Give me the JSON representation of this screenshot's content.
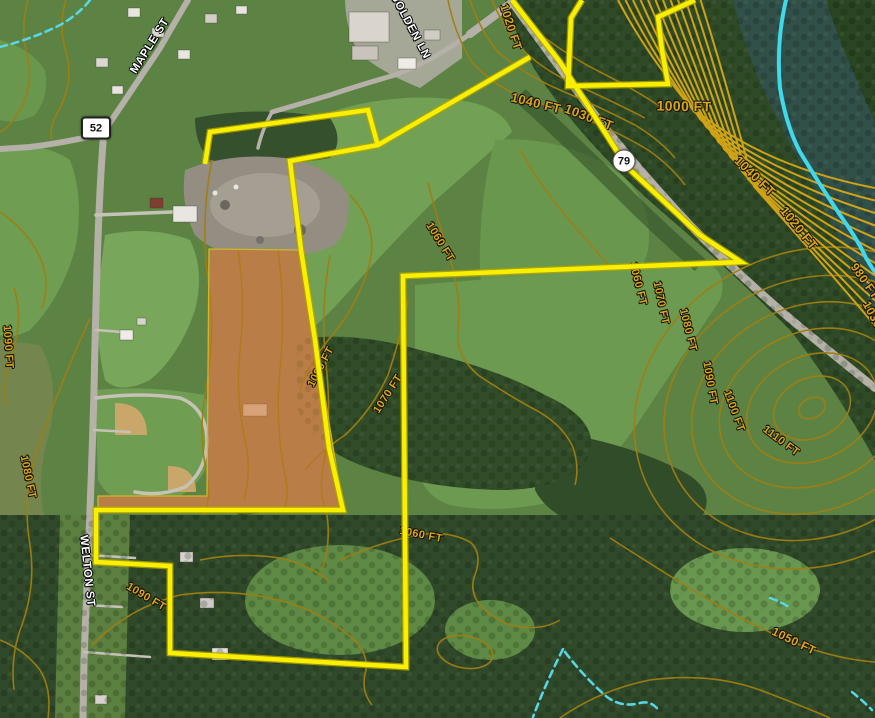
{
  "map": {
    "street_labels": [
      {
        "text": "MAPLE ST",
        "x": 150,
        "y": 46,
        "rot": -58
      },
      {
        "text": "GOLDEN LN",
        "x": 410,
        "y": 26,
        "rot": 62
      },
      {
        "text": "WELTON ST",
        "x": 87,
        "y": 571,
        "rot": 84
      }
    ],
    "route_shields": [
      {
        "number": "52",
        "shape": "rect",
        "x": 96,
        "y": 128
      },
      {
        "number": "79",
        "shape": "circle",
        "x": 624,
        "y": 161
      }
    ],
    "contour_labels": [
      {
        "text": "1020 FT",
        "x": 511,
        "y": 27,
        "rot": 72,
        "size": 12
      },
      {
        "text": "1040 FT",
        "x": 536,
        "y": 103,
        "rot": 14,
        "size": 13
      },
      {
        "text": "1030 FT",
        "x": 589,
        "y": 117,
        "rot": 21,
        "size": 13
      },
      {
        "text": "1000 FT",
        "x": 684,
        "y": 106,
        "rot": 1,
        "size": 14
      },
      {
        "text": "1040 FT",
        "x": 755,
        "y": 176,
        "rot": 44,
        "size": 13
      },
      {
        "text": "1020 FT",
        "x": 799,
        "y": 228,
        "rot": 51,
        "size": 13
      },
      {
        "text": "980 FT",
        "x": 865,
        "y": 281,
        "rot": 55,
        "size": 12
      },
      {
        "text": "1030 FT",
        "x": 877,
        "y": 323,
        "rot": 62,
        "size": 12
      },
      {
        "text": "1060 FT",
        "x": 638,
        "y": 284,
        "rot": 76,
        "size": 11
      },
      {
        "text": "1070 FT",
        "x": 661,
        "y": 303,
        "rot": 78,
        "size": 11
      },
      {
        "text": "1080 FT",
        "x": 688,
        "y": 330,
        "rot": 76,
        "size": 11
      },
      {
        "text": "1090 FT",
        "x": 710,
        "y": 383,
        "rot": 80,
        "size": 11
      },
      {
        "text": "1100 FT",
        "x": 734,
        "y": 411,
        "rot": 70,
        "size": 11
      },
      {
        "text": "1110 FT",
        "x": 781,
        "y": 441,
        "rot": 37,
        "size": 11
      },
      {
        "text": "1060 FT",
        "x": 440,
        "y": 242,
        "rot": 58,
        "size": 11
      },
      {
        "text": "1070 FT",
        "x": 388,
        "y": 394,
        "rot": -57,
        "size": 11
      },
      {
        "text": "1080 FT",
        "x": 321,
        "y": 367,
        "rot": -62,
        "size": 11
      },
      {
        "text": "1090 FT",
        "x": 8,
        "y": 347,
        "rot": 86,
        "size": 11
      },
      {
        "text": "1080 FT",
        "x": 28,
        "y": 477,
        "rot": 78,
        "size": 11
      },
      {
        "text": "1090 FT",
        "x": 146,
        "y": 597,
        "rot": 31,
        "size": 11
      },
      {
        "text": "1060 FT",
        "x": 421,
        "y": 535,
        "rot": 11,
        "size": 11
      },
      {
        "text": "1050 FT",
        "x": 794,
        "y": 641,
        "rot": 26,
        "size": 12
      }
    ],
    "colors": {
      "boundary_yellow": "#f5ee00",
      "parcel_overlay_orange": "#c9712d",
      "contour_line": "#9f7f12",
      "contour_label": "#d8a61c",
      "river_centerline": "#3fd9ec",
      "stream_blue": "#58d7e8"
    }
  }
}
